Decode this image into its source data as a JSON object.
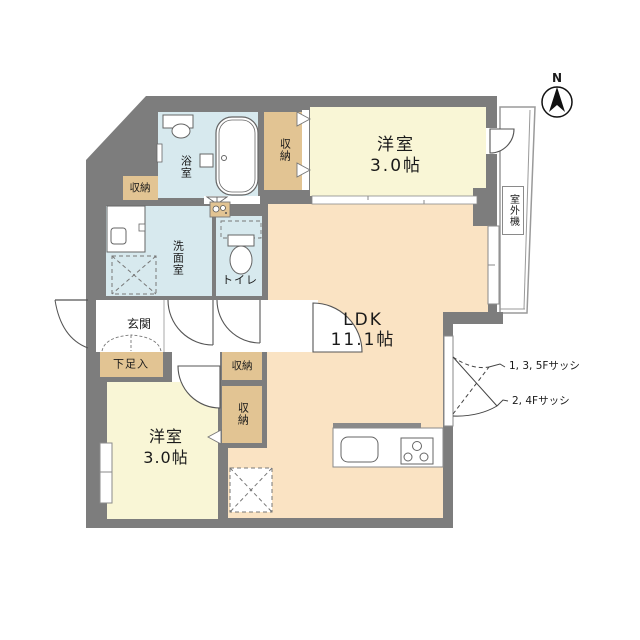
{
  "colors": {
    "wall": "#7d7d7d",
    "wet_room": "#d7e9ee",
    "bedroom": "#f9f6d6",
    "ldk": "#fae3c3",
    "closet": "#e2c493",
    "white": "#ffffff",
    "outline": "#8a8a8a",
    "balcony_line": "#9a9a9a"
  },
  "compass": {
    "north": "N"
  },
  "rooms": {
    "bath": {
      "label": "浴室"
    },
    "washroom": {
      "label": "洗面室"
    },
    "toilet": {
      "label": "トイレ"
    },
    "entrance": {
      "label": "玄関"
    },
    "shoe_cabinet": {
      "label": "下足入"
    },
    "bedroom_upper": {
      "name": "洋室",
      "size": "3.0帖"
    },
    "bedroom_lower": {
      "name": "洋室",
      "size": "3.0帖"
    },
    "ldk": {
      "name": "LDK",
      "size": "11.1帖"
    },
    "outdoor_unit": {
      "label": "室外機"
    },
    "closet_upper_left": {
      "label": "収納"
    },
    "closet_upper_center": {
      "label": "収納"
    },
    "closet_hall": {
      "label": "収納"
    },
    "closet_lower": {
      "label": "収納"
    }
  },
  "annotations": {
    "sash_upper": "1, 3, 5Fサッシ",
    "sash_lower": "2, 4Fサッシ"
  }
}
